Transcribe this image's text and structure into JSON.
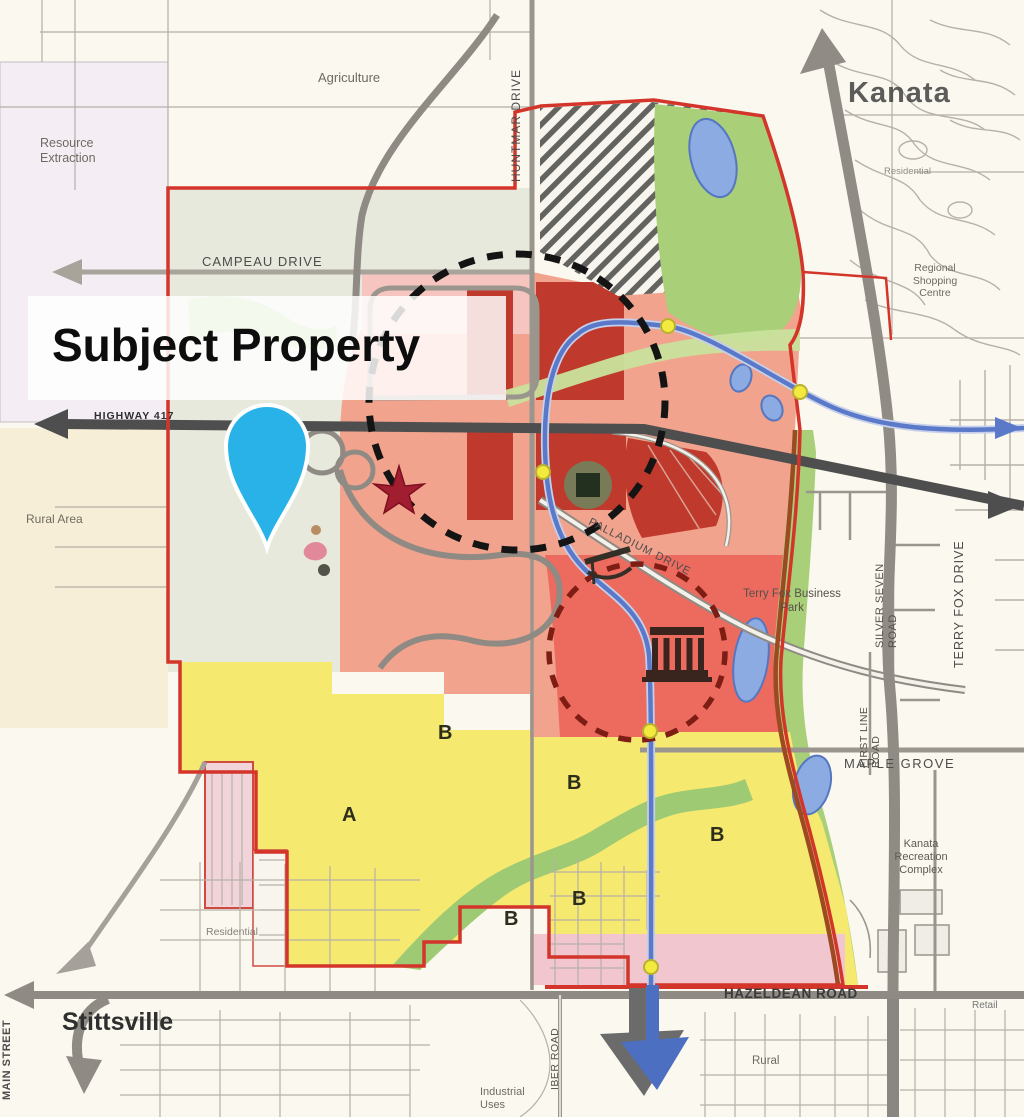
{
  "overlay": {
    "subject_property": "Subject Property"
  },
  "places": {
    "kanata": "Kanata",
    "stittsville": "Stittsville",
    "agriculture": "Agriculture",
    "resource_extraction": "Resource Extraction",
    "rural_area": "Rural Area",
    "rural": "Rural",
    "retail": "Retail",
    "residential_kanata": "Residential",
    "residential_stittsville": "Residential",
    "industrial_uses": "Industrial Uses",
    "regional_shopping_centre": "Regional Shopping Centre",
    "kanata_recreation_complex": "Kanata Recreation Complex",
    "terry_fox_business_park": "Terry Fox Business Park"
  },
  "roads": {
    "campeau_drive": "CAMPEAU DRIVE",
    "huntmar_drive": "HUNTMAR DRIVE",
    "highway_417": "HIGHWAY 417",
    "palladium_drive": "PALLADIUM DRIVE",
    "maple_grove": "MAPLE GROVE",
    "hazeldean_road": "HAZELDEAN ROAD",
    "terry_fox_drive": "TERRY FOX DRIVE",
    "silver_seven_road": "SILVER SEVEN ROAD",
    "first_line_road": "FIRST LINE ROAD",
    "iber_road": "IBER ROAD",
    "main_street": "MAIN STREET"
  },
  "zone_letters": [
    {
      "letter": "B"
    },
    {
      "letter": "A"
    },
    {
      "letter": "B"
    },
    {
      "letter": "B"
    },
    {
      "letter": "B"
    },
    {
      "letter": "B"
    }
  ],
  "icons": {
    "subject_pin": "location-pin",
    "star": "red-star-marker",
    "arena": "arena-square",
    "grandstand": "grandstand",
    "monument": "classical-building",
    "runner": "runner-figure",
    "transit_stops": "yellow-station-dots"
  },
  "colors": {
    "pin_blue": "#29b2e8",
    "boundary_red": "#d4352a",
    "salmon_zone": "#f2a38d",
    "dark_red_blocks": "#bf3a2c",
    "red_zone": "#ed6b5e",
    "yellow_zone": "#f5e96f",
    "pink_zone": "#f2c6ce",
    "green_corridor": "#a9cf78",
    "pond_blue": "#8cabe3",
    "transit_blue": "#5b79c9",
    "highway_gray": "#4e4e4e",
    "road_gray": "#9a968e",
    "station_yellow": "#f2ea3f"
  }
}
